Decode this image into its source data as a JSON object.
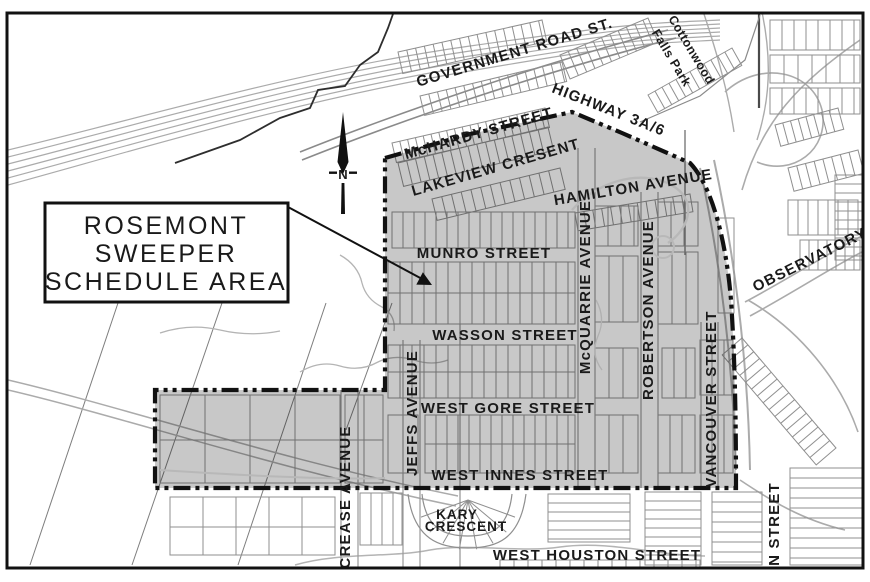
{
  "map": {
    "title_box": {
      "line1": "ROSEMONT",
      "line2": "SWEEPER",
      "line3": "SCHEDULE AREA"
    },
    "north_arrow": {
      "label": "N"
    },
    "labels": {
      "government_road": "GOVERNMENT ROAD ST.",
      "highway": "HIGHWAY 3A/6",
      "cottonwood_line1": "Cottonwood",
      "cottonwood_line2": "Falls Park",
      "mchardy": "McHARDY STREET",
      "lakeview": "LAKEVIEW CRESENT",
      "hamilton": "HAMILTON AVENUE",
      "munro": "MUNRO STREET",
      "wasson": "WASSON STREET",
      "mcquarrie": "McQUARRIE AVENUE",
      "robertson": "ROBERTSON AVENUE",
      "observatory": "OBSERVATORY",
      "west_gore": "WEST GORE STREET",
      "jeffs": "JEFFS AVENUE",
      "vancouver": "VANCOUVER STREET",
      "west_innes": "WEST INNES STREET",
      "crease": "CREASE AVENUE",
      "kary_line1": "KARY",
      "kary_line2": "CRESCENT",
      "west_houston": "WEST HOUSTON STREET",
      "an_street": "AN STREET"
    },
    "colors": {
      "background": "#ffffff",
      "sweeper_area_fill": "#c8c8c8",
      "boundary": "#111111",
      "frame": "#111111",
      "parcel_lines": "#8f8f8f",
      "road_lines": "#ababab",
      "label_text": "#1a1a1a"
    }
  }
}
